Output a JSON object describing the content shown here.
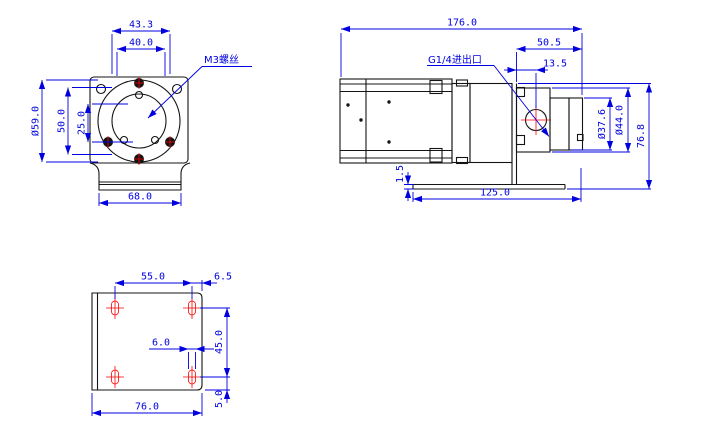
{
  "drawing": {
    "type": "engineering-dimension-drawing",
    "part": "gear pump with motor and mounting bracket",
    "background": "#ffffff",
    "colors": {
      "outline": "#141414",
      "dimension": "#0000e0",
      "highlight": "#ff0000"
    }
  },
  "front_view": {
    "callout": "M3螺丝",
    "dims": {
      "hole_span": "43.3",
      "pilot_width": "40.0",
      "flange_diameter": "Ø59.0",
      "mid_height": "50.0",
      "inner_height": "25.0",
      "base_width": "68.0"
    }
  },
  "side_view": {
    "callout": "G1/4进出口",
    "dims": {
      "overall_length": "176.0",
      "head_length": "50.5",
      "port_offset": "13.5",
      "body_diameter": "Ø37.6",
      "flange_diameter": "Ø44.0",
      "overall_height": "76.8",
      "base_thickness": "1.5",
      "base_length": "125.0"
    }
  },
  "bottom_view": {
    "dims": {
      "slot_span_x": "55.0",
      "edge_offset_x": "6.5",
      "slot_span_y": "45.0",
      "slot_width": "6.0",
      "edge_offset_y": "5.0",
      "plate_width": "76.0"
    }
  }
}
